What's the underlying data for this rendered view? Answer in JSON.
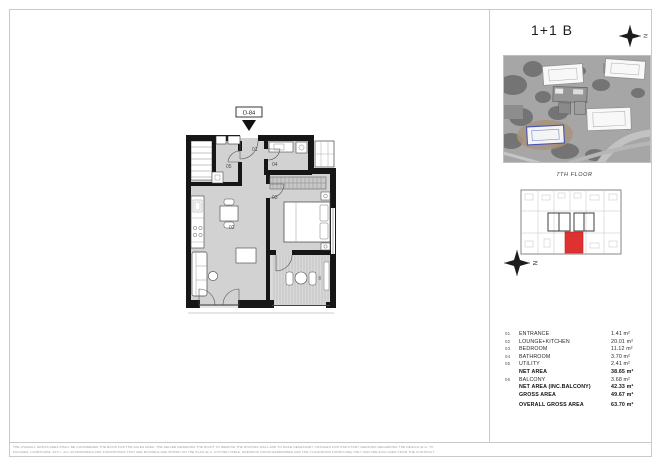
{
  "floorplan": {
    "unit_id": "D-84",
    "room_labels": {
      "entrance": "01",
      "lounge_kitchen": "02",
      "bedroom": "03",
      "bathroom": "04",
      "utility": "05",
      "balcony": "06"
    }
  },
  "panel": {
    "title": "1+1 B",
    "floor_label": "7TH FLOOR",
    "compass_letter": "N"
  },
  "area_table": {
    "rows": [
      {
        "num": "01",
        "label": "ENTRANCE",
        "value": "1.41 m²"
      },
      {
        "num": "02",
        "label": "LOUNGE+KITCHEN",
        "value": "20.01 m²"
      },
      {
        "num": "03",
        "label": "BEDROOM",
        "value": "11.12 m²"
      },
      {
        "num": "04",
        "label": "BATHROOM",
        "value": "3.70 m²"
      },
      {
        "num": "05",
        "label": "UTILITY",
        "value": "2.41 m²"
      },
      {
        "num": "",
        "label": "NET AREA",
        "value": "38.65 m²"
      },
      {
        "num": "06",
        "label": "BALCONY",
        "value": "3.68 m²"
      },
      {
        "num": "",
        "label": "NET AREA (INC.BALCONY)",
        "value": "42.33 m²"
      },
      {
        "num": "",
        "label": "GROSS AREA",
        "value": "49.67 m²"
      },
      {
        "num": "",
        "label": "OVERALL GROSS AREA",
        "value": "63.70 m²"
      }
    ]
  },
  "disclaimer": {
    "line1": "THE OVERALL GROSS AREA SHALL BE CONSIDERED THE BASIS FOR THE SALES AREA. THE SELLER RESERVES THE RIGHT TO REMOVE THE DIVIDING WALL AND TO MAKE NECESSARY CHANGES FOR STATUTORY REASONS REGARDING THE DESIGN (E.G. TO",
    "line2": "FACADES, LANDSCAPE, ETC.). ALL ACCESSORIES AND FURNISHINGS THAT ARE MOVABLE ARE SHOWN ON THE PLAN (E.G. KITCHEN TABLE, DRESSING ROOM WARDROBES AND THE CLOAKROOM FURNITURE) ONLY AND ARE EXCLUDED FROM THE CONTRACT"
  },
  "colors": {
    "unit_highlight": "#e03131",
    "plan_floor": "#d2d2d2",
    "wall": "#161616"
  }
}
